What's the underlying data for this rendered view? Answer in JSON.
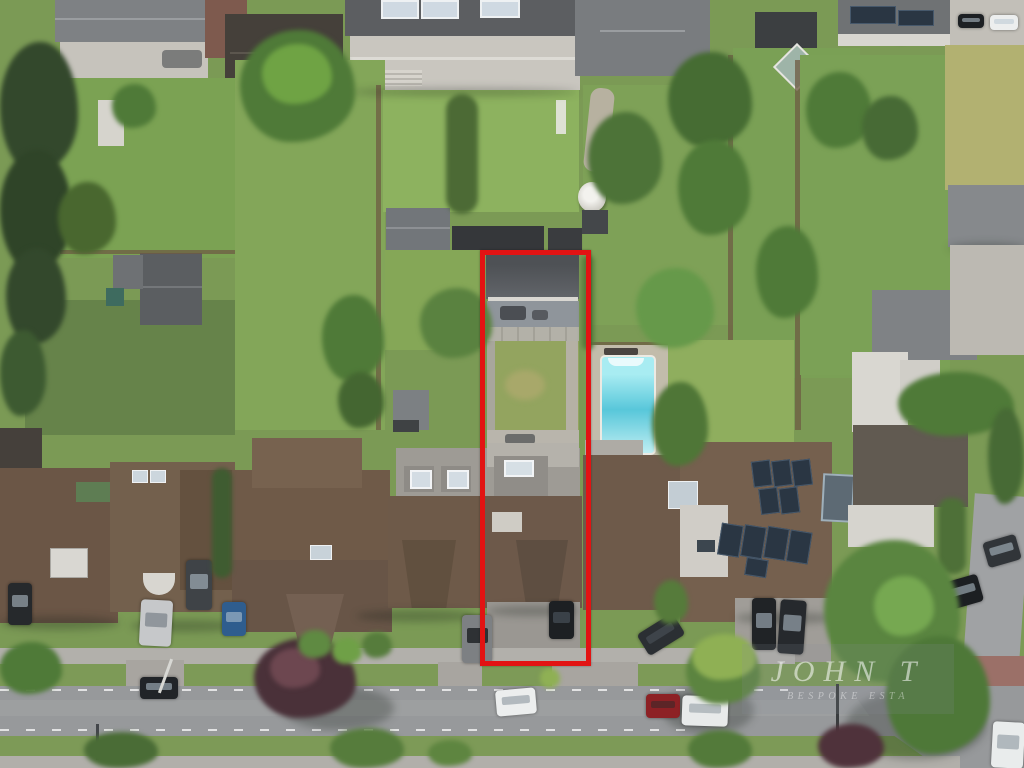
{
  "image": {
    "type": "aerial-photograph",
    "subject": "Bird's-eye drone view of a suburban residential street with rear gardens, a swimming pool, solar-panelled roofs and tree-lined verges",
    "highlight": "One long narrow property plot outlined with a thick red rectangle, from its rear garden outbuilding down to its street driveway",
    "width_px": 1024,
    "height_px": 768
  },
  "watermark": {
    "line1": "JOHN T",
    "line2": "BESPOKE ESTA"
  },
  "boundary": {
    "shape": "rectangle",
    "color": "#e21313",
    "encloses": "flat-roofed garden outbuilding, paved patio, rear lawn, house with dormer, driveway with parked black car"
  },
  "scene": {
    "notable_objects": [
      "red property boundary rectangle",
      "dark flat-roofed rear outbuilding",
      "swimming pool with paved surround",
      "roof with multiple solar panel arrays",
      "glass conservatory pyramids on top terrace house",
      "white parasols in gardens",
      "parked cars on street and driveways",
      "purple-leaved verge tree",
      "street junction at bottom right",
      "brick-paved corner at bottom right with white car"
    ]
  },
  "palette": {
    "lawn": "#7b9a55",
    "lawn_bright": "#8db25f",
    "lawn_shade": "#66834a",
    "lawn_dry": "#b2b171",
    "verge": "#7d9a57",
    "road": "#97999b",
    "sidewalk": "#b2b0ab",
    "patio": "#c6c3bc",
    "brick": "#9b7068",
    "roof_brown": "#6e5a49",
    "roof_brown_dark": "#5e4e41",
    "roof_grey": "#7a7d80",
    "roof_dark": "#3c3f42",
    "pool": "#58c7da",
    "solar": "#2a3643",
    "fencec": "#6d5b43",
    "tree_dark": "#33482c",
    "tree_mid": "#4f7a38",
    "tree_light": "#6fa344",
    "tree_bright": "#8fb054",
    "tree_purple": "#4a3139",
    "red_boundary": "#e21313",
    "car_black": "#1d2023",
    "car_white": "#eceeee",
    "car_red": "#8d2125",
    "car_silver": "#c6c8ca",
    "car_blue": "#2f5d8e",
    "car_grey": "#6f7478"
  }
}
